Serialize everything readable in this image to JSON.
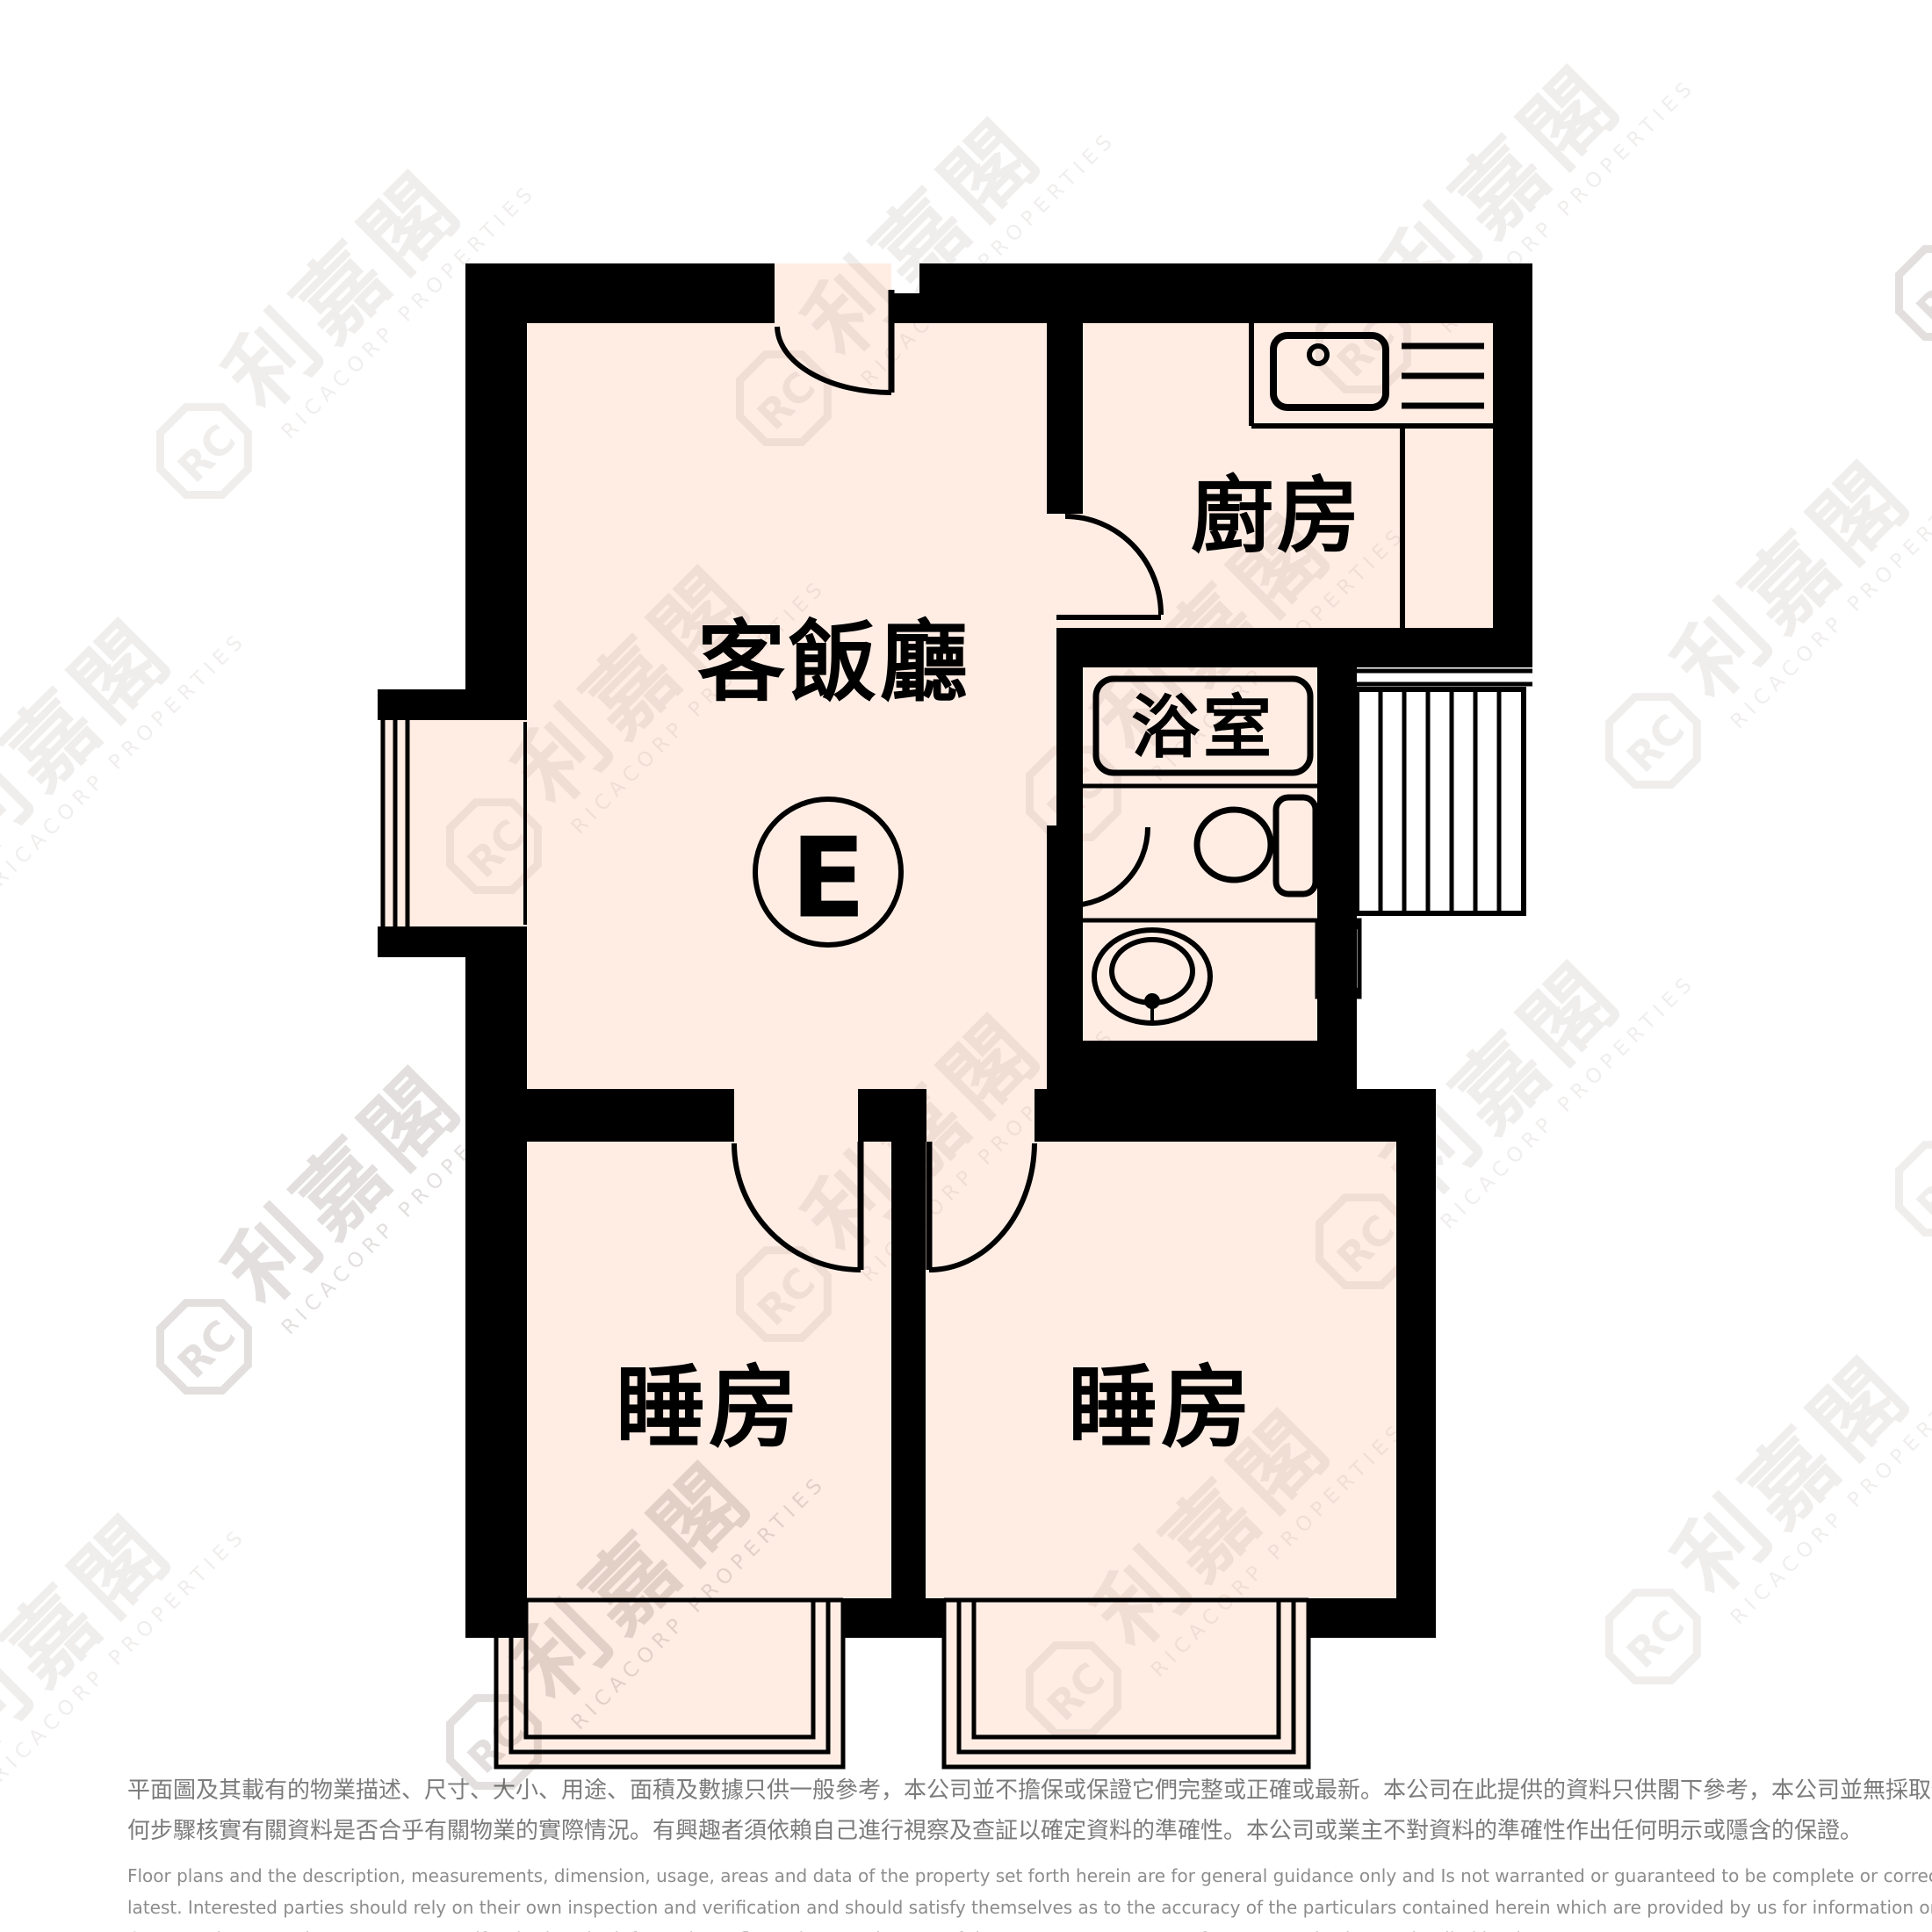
{
  "unit": {
    "label": "E"
  },
  "rooms": {
    "living_dining": "客飯廳",
    "kitchen": "廚房",
    "bathroom": "浴室",
    "bedroom_left": "睡房",
    "bedroom_right": "睡房"
  },
  "watermark": {
    "cjk": "利嘉閣",
    "latin": "RICACORP PROPERTIES",
    "logo_monogram": "RC"
  },
  "colors": {
    "floor": "#FFEDE4",
    "wall": "#000000",
    "watermark_tint": "#4E3E34",
    "disclaimer_zh": "#7C7C7C",
    "disclaimer_en": "#8D8D8D"
  },
  "disclaimer": {
    "zh_lines": [
      "平面圖及其載有的物業描述、尺寸、大小、用途、面積及數據只供一般參考，本公司並不擔保或保證它們完整或正確或最新。本公司在此提供的資料只供閣下參考，本公司並無採取任",
      "何步驟核實有關資料是否合乎有關物業的實際情況。有興趣者須依賴自己進行視察及查証以確定資料的準確性。本公司或業主不對資料的準確性作出任何明示或隱含的保證。"
    ],
    "en_lines": [
      "Floor plans and the description, measurements, dimension, usage, areas and data of the property set forth herein are for general guidance only and Is not warranted or guaranteed to be complete or correct or the",
      "latest. Interested parties should rely on their own inspection and verification and should satisfy themselves as to the accuracy of the particulars contained herein which are provided by us for information only.  Our",
      "Company has not taken any step to verify whether the information reflects the actual status of the property.  No warranty for accuracy is given or implied by the owners or us."
    ]
  }
}
